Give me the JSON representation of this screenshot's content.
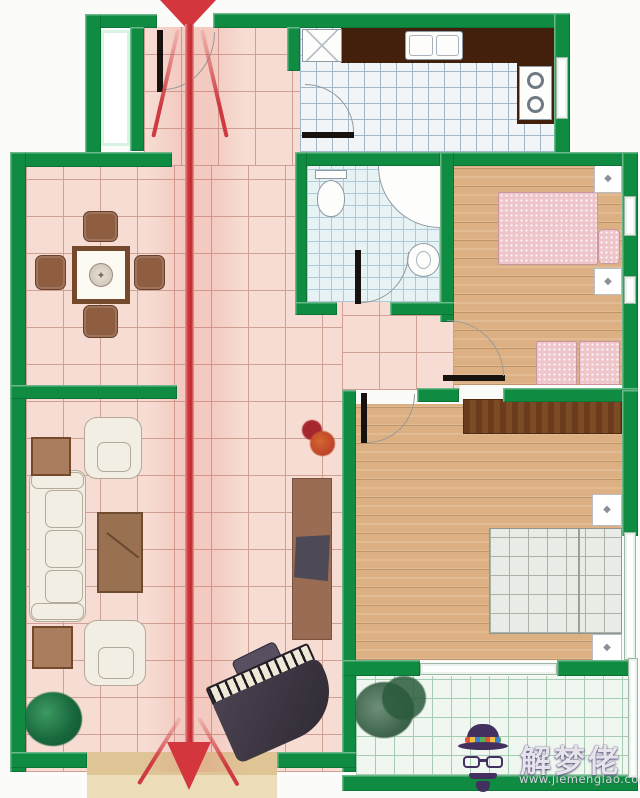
{
  "meta": {
    "type": "apartment floor plan (feng-shui through-draft illustration)",
    "width_px": 640,
    "height_px": 798
  },
  "arrow": {
    "meaning": "straight path from the entry door through the home and out the bottom",
    "direction": "top-to-bottom",
    "heads": [
      "large head at entry (top)",
      "large head at exit (bottom)"
    ],
    "side_rays": 4
  },
  "rooms": [
    {
      "id": "entry-hall",
      "floor": "pink-tile",
      "features": [
        "entry-door",
        "entry-niche"
      ]
    },
    {
      "id": "kitchen",
      "floor": "white-tile",
      "furniture": [
        "fridge",
        "l-shaped-counter",
        "double-sink",
        "two-burner-stove",
        "window"
      ]
    },
    {
      "id": "dining-area",
      "floor": "pink-tile",
      "furniture": [
        "square-table-with-medallion",
        "four-chairs"
      ]
    },
    {
      "id": "bathroom",
      "floor": "blue-tile",
      "furniture": [
        "toilet",
        "corner-shower",
        "round-sink"
      ]
    },
    {
      "id": "bedroom-top-right",
      "floor": "wood",
      "furniture": [
        "double-bed",
        "pillow",
        "two-nightstands",
        "two-seat-bench",
        "windows"
      ]
    },
    {
      "id": "bedroom-bottom-right",
      "floor": "wood",
      "furniture": [
        "wardrobe",
        "double-bed",
        "two-nightstands",
        "window"
      ]
    },
    {
      "id": "living-room",
      "floor": "pink-tile",
      "furniture": [
        "three-seat-sofa",
        "two-armchairs",
        "two-side-tables",
        "coffee-table",
        "tv-cabinet",
        "tv",
        "potted-plant",
        "red-flowers",
        "grand-piano",
        "piano-bench"
      ]
    },
    {
      "id": "balcony-bottom-right",
      "floor": "green-tile",
      "furniture": [
        "potted-plant"
      ]
    }
  ],
  "icons": {
    "diamond": "◆",
    "medallion": "✦"
  },
  "watermark": {
    "brand": "解梦佬",
    "url": "www.jiemenglao.com",
    "icon": "detective-hat-glasses-beard"
  },
  "colors": {
    "wall": "#0f8c42",
    "floorPink": "#f6dcd2",
    "floorGrid": "#cfa093",
    "wood": "#dcb083",
    "woodLine": "#bf9468",
    "kitchenFloor": "#f1f5f8",
    "kitchenGrid": "#a2b8c8",
    "bathFloor": "#e7f2f5",
    "bathGrid": "#aecad6",
    "balconyFloor": "#eff7f0",
    "balconyGrid": "#a7ccb4",
    "counter": "#42200c",
    "wardrobe": "#74431f",
    "bedPink": "#eec5cb",
    "bedPinkLine": "#c897a2",
    "bedPlaid": "#e9ece6",
    "bedPlaidLine": "#a9b3a9",
    "sofa": "#f2eee3",
    "sofaLine": "#b4aa99",
    "tableBorder": "#74492c",
    "tableTop": "#fdf9f3",
    "chair": "#8f5d40",
    "coffee": "#997050",
    "sideTable": "#aa7d5e",
    "plantDark": "#135c33",
    "plantSoft": "#4c7259",
    "cabinet": "#9a6c53",
    "tv": "#4e4956",
    "exitTan": "#dfc496",
    "exitTanLight": "#ecdcba",
    "arrow": "#d4363e",
    "leaf": "#17120e",
    "arc": "#9a9a98",
    "fixture": "#8e9aa6",
    "wmPurple": "#43305f",
    "wmText": "#e6e3ec",
    "wmUrl": "#d4d7de"
  }
}
